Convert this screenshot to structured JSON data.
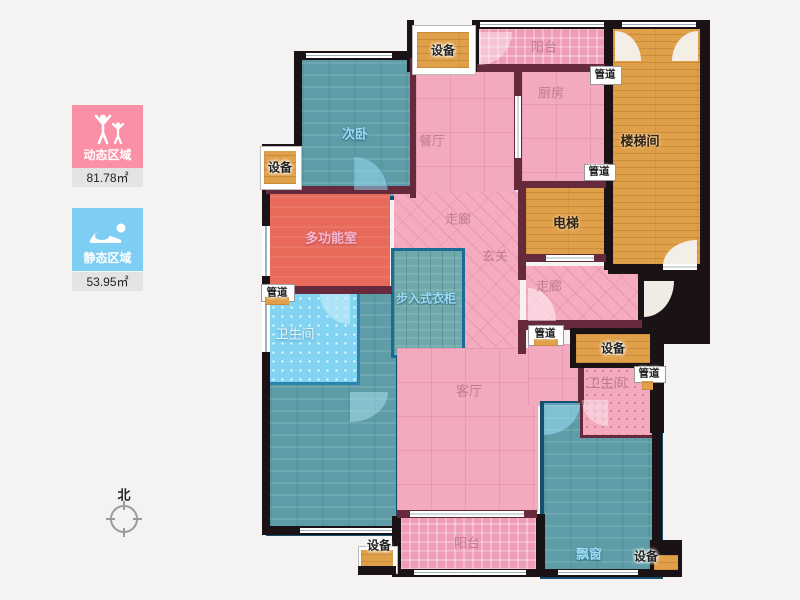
{
  "legend": {
    "dynamic_label": "动态区域",
    "dynamic_area": "81.78㎡",
    "static_label": "静态区域",
    "static_area": "53.95㎡"
  },
  "compass": {
    "north_label": "北"
  },
  "rooms": {
    "bedroom2": "次卧",
    "dining": "餐厅",
    "kitchen": "厨房",
    "balcony": "阳台",
    "stairwell": "楼梯间",
    "elevator": "电梯",
    "multi": "多功能室",
    "corridor": "走廊",
    "foyer": "玄关",
    "closet": "步入式衣柜",
    "bathroom": "卫生间",
    "living": "客厅",
    "baywindow": "飘窗"
  },
  "fixtures": {
    "equipment": "设备",
    "pipe": "管道"
  },
  "colors": {
    "legend_dynamic": "#fb8fa6",
    "legend_static": "#7ecef3",
    "room_pink": "#f3a9be",
    "room_teal": "#5e9da7",
    "room_lightblue": "#82d4f2",
    "room_red": "#e76a5b",
    "room_wood": "#e0a049",
    "wall_dark": "#1b1216",
    "wall_maroon": "#67293c"
  }
}
